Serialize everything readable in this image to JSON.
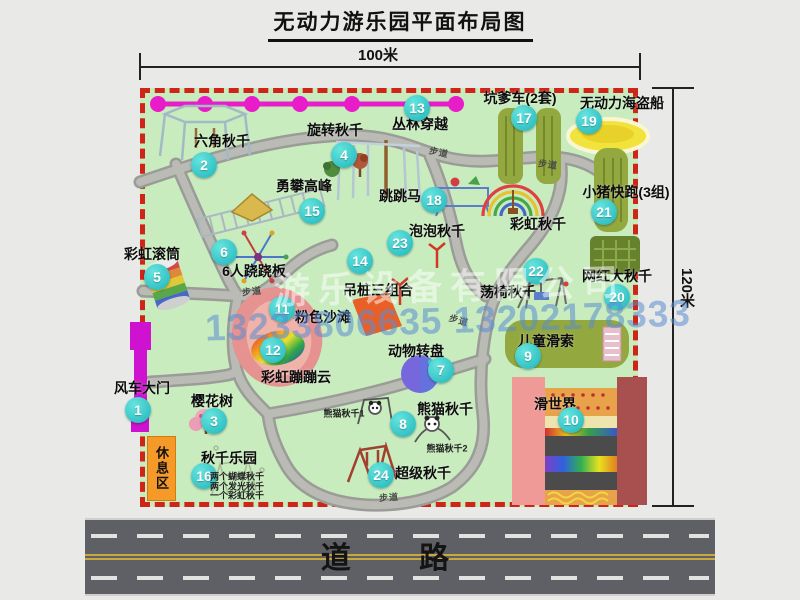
{
  "title": "无动力游乐园平面布局图",
  "dimensions": {
    "width_label": "100米",
    "height_label": "120米"
  },
  "road": {
    "label": "道 路"
  },
  "watermark": {
    "company": "游乐设备有限公司",
    "phone": "13233806635 13202178333"
  },
  "path_label": "步道",
  "rest_area_label": "休息区",
  "attractions": [
    {
      "num": "1",
      "label": "风车大门"
    },
    {
      "num": "2",
      "label": "六角秋千"
    },
    {
      "num": "3",
      "label": "樱花树"
    },
    {
      "num": "4",
      "label": "旋转秋千"
    },
    {
      "num": "5",
      "label": "彩虹滚筒"
    },
    {
      "num": "6",
      "label": "6人跷跷板"
    },
    {
      "num": "7",
      "label": "动物转盘"
    },
    {
      "num": "8",
      "label": "熊猫秋千",
      "sub": [
        "熊猫秋千1",
        "熊猫秋千2"
      ]
    },
    {
      "num": "9",
      "label": "儿童滑索"
    },
    {
      "num": "10",
      "label": "滑世界"
    },
    {
      "num": "11",
      "label": "粉色沙滩"
    },
    {
      "num": "12",
      "label": "彩虹蹦蹦云"
    },
    {
      "num": "13",
      "label": "丛林穿越"
    },
    {
      "num": "14",
      "label": "吊桩三组合"
    },
    {
      "num": "15",
      "label": "勇攀高峰"
    },
    {
      "num": "16",
      "label": "秋千乐园",
      "sub": [
        "两个蝴蝶秋千",
        "两个发光秋千",
        "一个彩虹秋千"
      ]
    },
    {
      "num": "17",
      "label": "坑爹车(2套)"
    },
    {
      "num": "18",
      "label": "跳跳马"
    },
    {
      "num": "19",
      "label": "无动力海盗船"
    },
    {
      "num": "20",
      "label": "网红大秋千"
    },
    {
      "num": "21",
      "label": "小猪快跑(3组)"
    },
    {
      "num": "22",
      "label": "荡椅秋千"
    },
    {
      "num": "23",
      "label": "泡泡秋千"
    },
    {
      "num": "24",
      "label": "超级秋千"
    }
  ],
  "extra_labels": [
    {
      "label": "彩虹秋千"
    }
  ],
  "colors": {
    "map_green": "#c8ecbe",
    "border_red": "#cf2518",
    "badge_teal": "#1fb5ba",
    "road_gray": "#5f5f66",
    "gate_magenta": "#cf12cf",
    "zipline_magenta": "#e81cc8",
    "rest_area_orange": "#f59a28",
    "beach_pink": "#e59290"
  }
}
